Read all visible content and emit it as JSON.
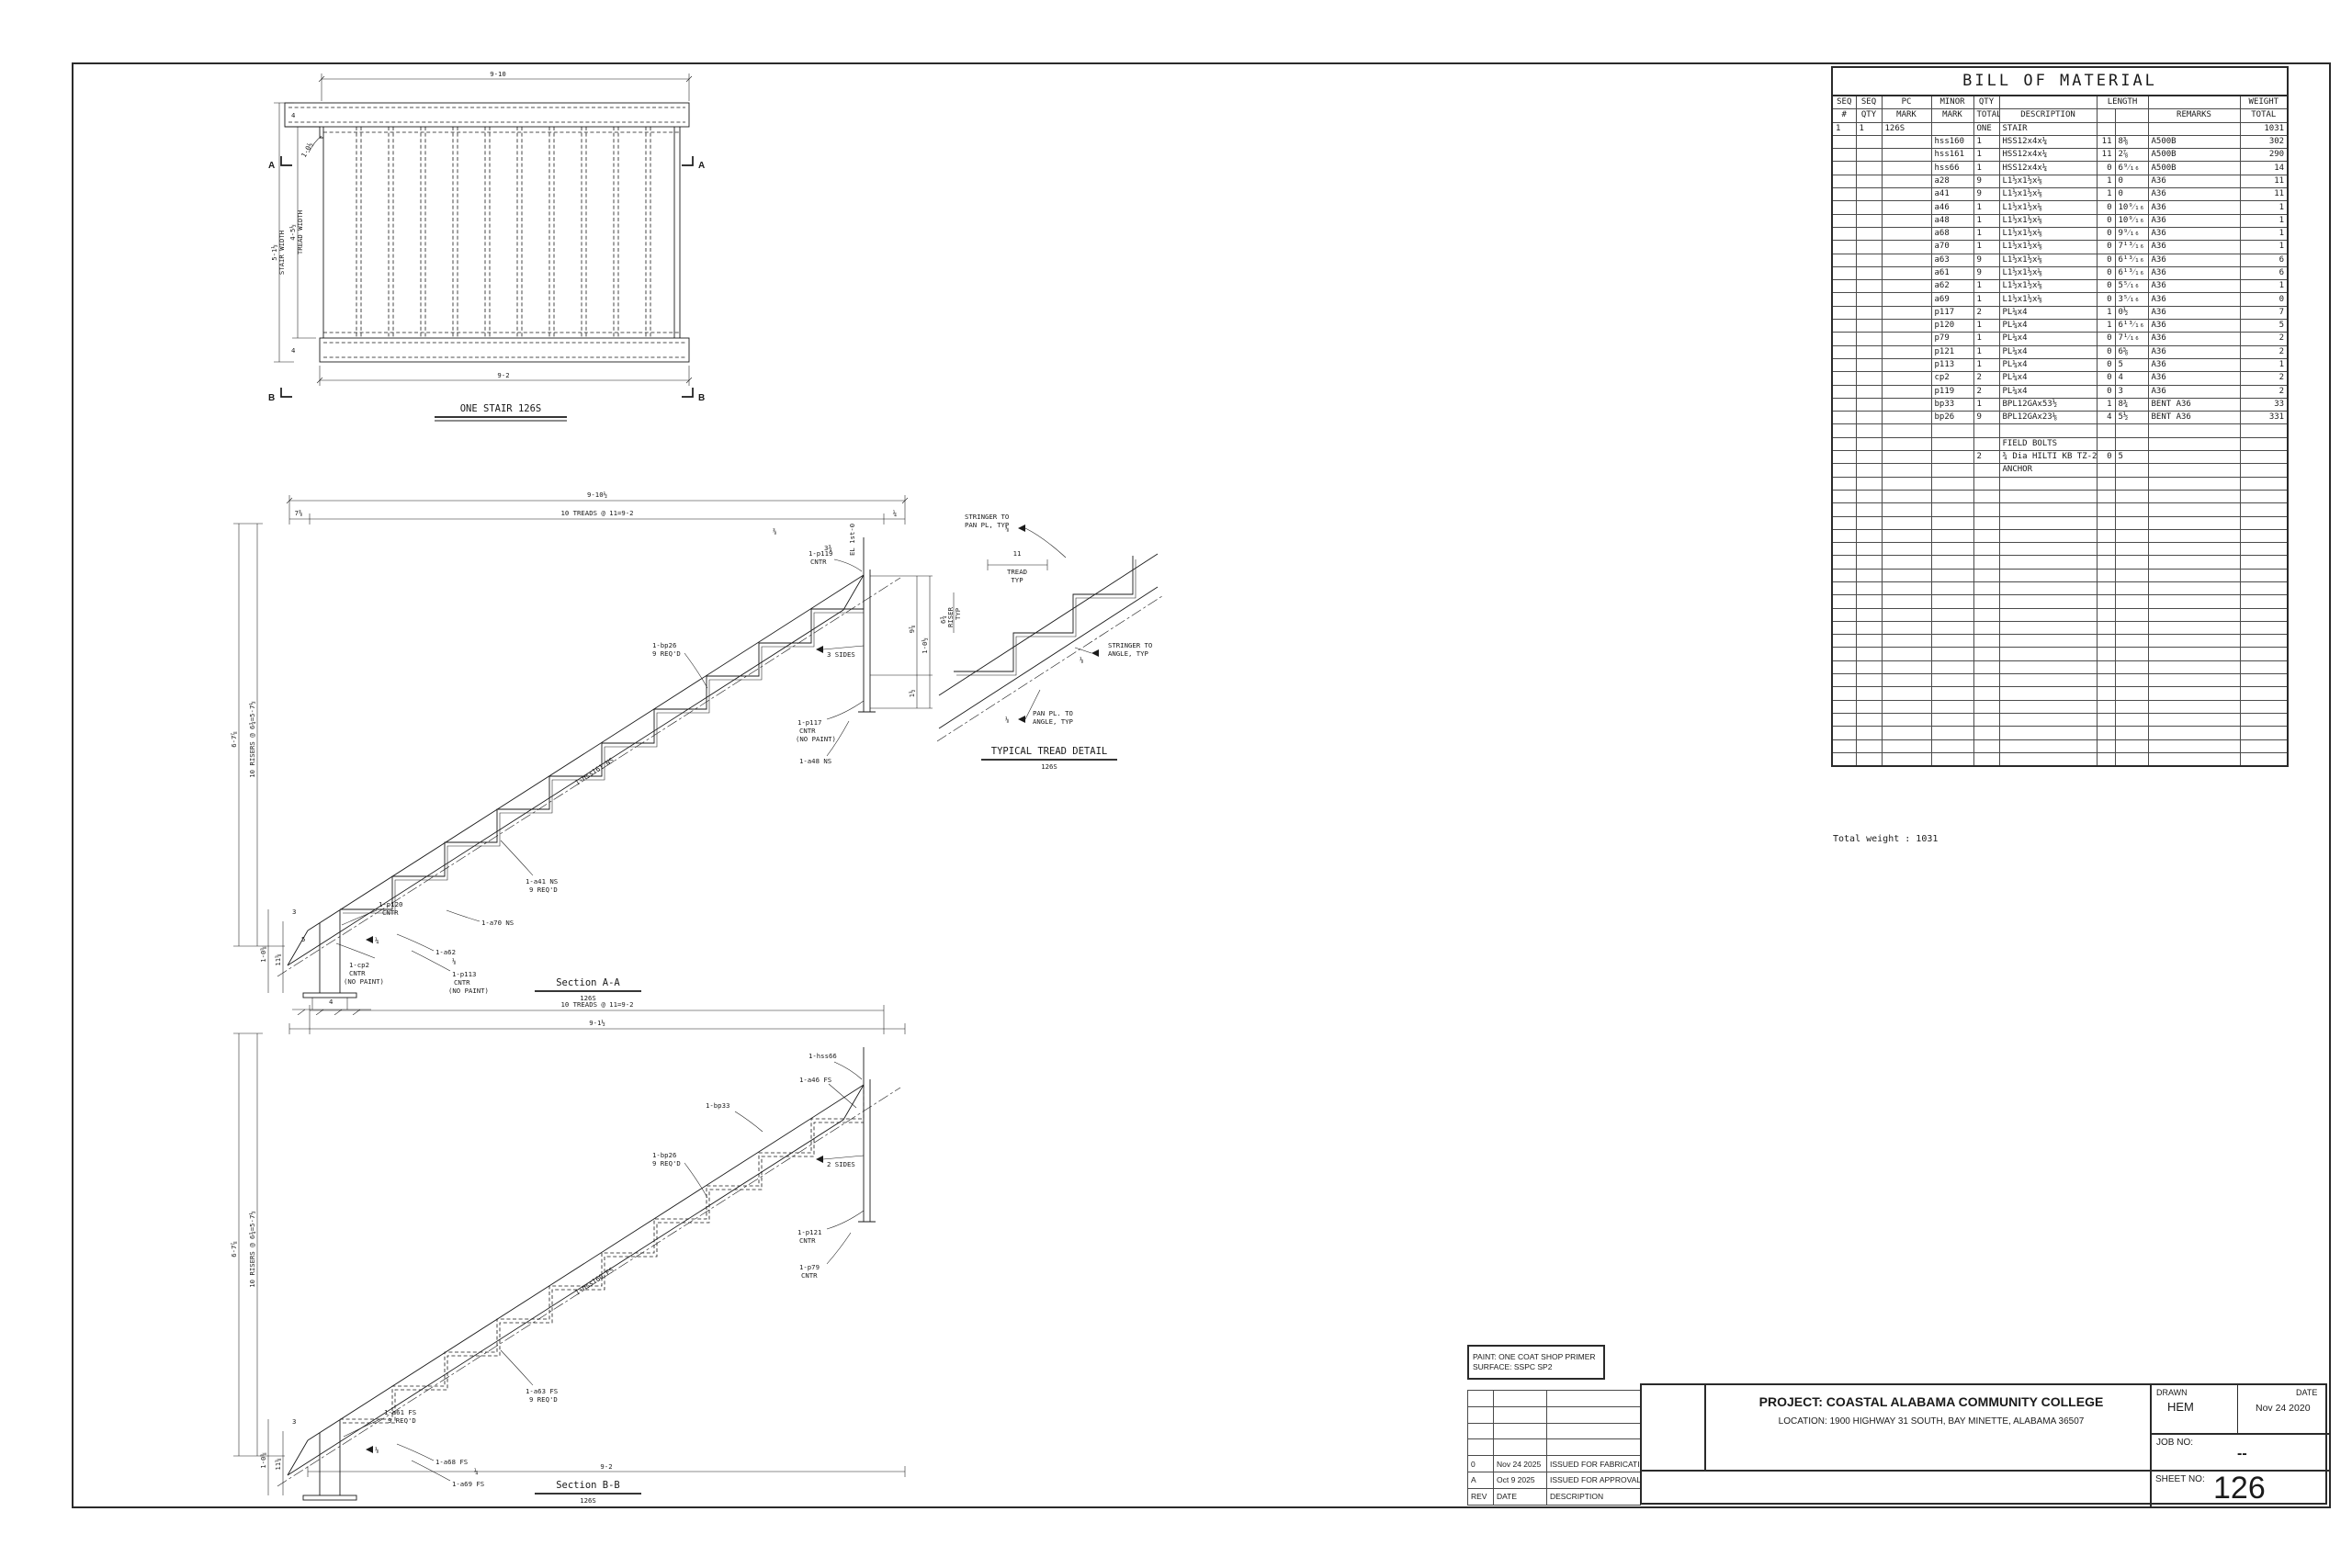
{
  "plan": {
    "title": "ONE STAIR 126S",
    "dim_top": "9-10",
    "dim_bottom": "9-2",
    "sw": "5-1½",
    "sw2": "STAIR WIDTH",
    "tw": "4-5½",
    "tw2": "TREAD WIDTH",
    "d4a": "4",
    "d4b": "4",
    "leader": "1-0½",
    "mA": "A",
    "mB": "B"
  },
  "section_a": {
    "title": "Section A-A",
    "ref": "126S",
    "dim_overall": "9-10½",
    "dim_l": "7⅜",
    "dim_treads": "10 TREADS @ 11=9-2",
    "dim_r": "¼",
    "dim_h_outer": "6-7⅞",
    "dim_risers": "10 RISERS @ 6¾=5-7½",
    "d_38": "⅜",
    "d_334": "3¾",
    "d_978": "9⅞",
    "d_112": "1½",
    "d_1012": "1-0½",
    "d_1058": "1-0⅝",
    "d_1158": "11⅝",
    "d_3": "3",
    "d_5": "5",
    "d_4": "4",
    "el": "EL 1st-0",
    "p119": "1-p119",
    "p119b": "CNTR",
    "sides3": "3 SIDES",
    "p117": "1-p117",
    "p117b": "CNTR",
    "p117c": "(NO PAINT)",
    "a48": "1-a48 NS",
    "bp26": "1-bp26",
    "bp26b": "9 REQ'D",
    "hss": "1-hss161 NS",
    "a41": "1-a41 NS",
    "a41b": "9 REQ'D",
    "a70": "1-a70 NS",
    "p120": "1-p120",
    "p120b": "CNTR",
    "cp2": "1-cp2",
    "cp2b": "CNTR",
    "cp2c": "(NO PAINT)",
    "a62": "1-a62",
    "p113": "1-p113",
    "p113b": "CNTR",
    "p113c": "(NO PAINT)",
    "w14": "¼",
    "w18": "⅛"
  },
  "section_b": {
    "title": "Section B-B",
    "ref": "126S",
    "dim_treads": "10 TREADS @ 11=9-2",
    "dim_912": "9-1½",
    "dim_bottom": "9-2",
    "dim_h_outer": "6-7⅞",
    "dim_risers": "10 RISERS @ 6¾=5-7½",
    "d_1058": "1-0⅝",
    "d_1158": "11⅝",
    "d_3": "3",
    "hss": "1-hss160 FS",
    "hss66": "1-hss66",
    "a46": "1-a46 FS",
    "sides2": "2 SIDES",
    "p121": "1-p121",
    "p121b": "CNTR",
    "p79": "1-p79",
    "p79b": "CNTR",
    "bp33": "1-bp33",
    "bp26": "1-bp26",
    "bp26b": "9 REQ'D",
    "a63": "1-a63 FS",
    "a63b": "9 REQ'D",
    "a61": "1-a61 FS",
    "a61b": "9 REQ'D",
    "a68": "1-a68 FS",
    "a69": "1-a69 FS",
    "w14": "¼",
    "w18": "⅛"
  },
  "tread_detail": {
    "title": "TYPICAL TREAD DETAIL",
    "ref": "126S",
    "s1": "STRINGER TO",
    "s1b": "PAN PL, TYP",
    "t11": "11",
    "t11b": "TREAD",
    "t11c": "TYP",
    "r": "6¾",
    "rb": "RISER",
    "rc": "TYP",
    "s2": "STRINGER TO",
    "s2b": "ANGLE, TYP",
    "s3": "PAN PL. TO",
    "s3b": "ANGLE, TYP",
    "w18": "⅛"
  },
  "bom": {
    "title": "BILL OF MATERIAL",
    "h": {
      "seq": "SEQ",
      "num": "#",
      "seq2": "SEQ",
      "qty": "QTY",
      "pc": "PC",
      "mark": "MARK",
      "minor": "MINOR",
      "mark2": "MARK",
      "qty2": "QTY",
      "total": "TOTAL",
      "desc": "DESCRIPTION",
      "length": "LENGTH",
      "remarks": "REMARKS",
      "weight": "WEIGHT",
      "wtotal": "TOTAL"
    },
    "rows": [
      [
        "1",
        "1",
        "126S",
        "",
        "ONE",
        "STAIR",
        "",
        "",
        "",
        "1031"
      ],
      [
        "",
        "",
        "",
        "hss160",
        "1",
        "HSS12x4x¼",
        "11",
        "8⅜",
        "A500B",
        "302"
      ],
      [
        "",
        "",
        "",
        "hss161",
        "1",
        "HSS12x4x¼",
        "11",
        "2⅞",
        "A500B",
        "290"
      ],
      [
        "",
        "",
        "",
        "hss66",
        "1",
        "HSS12x4x¼",
        "0",
        "6⁹⁄₁₆",
        "A500B",
        "14"
      ],
      [
        "",
        "",
        "",
        "a28",
        "9",
        "L1½x1½x⅛",
        "1",
        "0",
        "A36",
        "11"
      ],
      [
        "",
        "",
        "",
        "a41",
        "9",
        "L1½x1½x⅛",
        "1",
        "0",
        "A36",
        "11"
      ],
      [
        "",
        "",
        "",
        "a46",
        "1",
        "L1½x1½x⅛",
        "0",
        "10⁹⁄₁₆",
        "A36",
        "1"
      ],
      [
        "",
        "",
        "",
        "a48",
        "1",
        "L1½x1½x⅛",
        "0",
        "10⁹⁄₁₆",
        "A36",
        "1"
      ],
      [
        "",
        "",
        "",
        "a68",
        "1",
        "L1½x1½x⅛",
        "0",
        "9⁹⁄₁₆",
        "A36",
        "1"
      ],
      [
        "",
        "",
        "",
        "a70",
        "1",
        "L1½x1½x⅛",
        "0",
        "7¹³⁄₁₆",
        "A36",
        "1"
      ],
      [
        "",
        "",
        "",
        "a63",
        "9",
        "L1½x1½x⅛",
        "0",
        "6¹³⁄₁₆",
        "A36",
        "6"
      ],
      [
        "",
        "",
        "",
        "a61",
        "9",
        "L1½x1½x⅛",
        "0",
        "6¹³⁄₁₆",
        "A36",
        "6"
      ],
      [
        "",
        "",
        "",
        "a62",
        "1",
        "L1½x1½x⅛",
        "0",
        "5⁵⁄₁₆",
        "A36",
        "1"
      ],
      [
        "",
        "",
        "",
        "a69",
        "1",
        "L1½x1½x⅛",
        "0",
        "3⁵⁄₁₆",
        "A36",
        "0"
      ],
      [
        "",
        "",
        "",
        "p117",
        "2",
        "PL¼x4",
        "1",
        "0½",
        "A36",
        "7"
      ],
      [
        "",
        "",
        "",
        "p120",
        "1",
        "PL¼x4",
        "1",
        "6¹³⁄₁₆",
        "A36",
        "5"
      ],
      [
        "",
        "",
        "",
        "p79",
        "1",
        "PL¼x4",
        "0",
        "7¹⁄₁₆",
        "A36",
        "2"
      ],
      [
        "",
        "",
        "",
        "p121",
        "1",
        "PL¼x4",
        "0",
        "6⅝",
        "A36",
        "2"
      ],
      [
        "",
        "",
        "",
        "p113",
        "1",
        "PL¼x4",
        "0",
        "5",
        "A36",
        "1"
      ],
      [
        "",
        "",
        "",
        "cp2",
        "2",
        "PL¼x4",
        "0",
        "4",
        "A36",
        "2"
      ],
      [
        "",
        "",
        "",
        "p119",
        "2",
        "PL¼x4",
        "0",
        "3",
        "A36",
        "2"
      ],
      [
        "",
        "",
        "",
        "bp33",
        "1",
        "BPL12GAx53½",
        "1",
        "8¾",
        "BENT A36",
        "33"
      ],
      [
        "",
        "",
        "",
        "bp26",
        "9",
        "BPL12GAx23⅛",
        "4",
        "5½",
        "BENT A36",
        "331"
      ],
      [
        "",
        "",
        "",
        "",
        "",
        "",
        "",
        "",
        "",
        ""
      ],
      [
        "",
        "",
        "",
        "",
        "",
        "FIELD BOLTS",
        "",
        "",
        "",
        ""
      ],
      [
        "",
        "",
        "",
        "",
        "2",
        "¾ Dia HILTI KB TZ-2",
        "0",
        "5",
        "",
        ""
      ],
      [
        "",
        "",
        "",
        "",
        "",
        "ANCHOR",
        "",
        "",
        "",
        ""
      ],
      [
        "",
        "",
        "",
        "",
        "",
        "",
        "",
        "",
        "",
        ""
      ],
      [
        "",
        "",
        "",
        "",
        "",
        "",
        "",
        "",
        "",
        ""
      ],
      [
        "",
        "",
        "",
        "",
        "",
        "",
        "",
        "",
        "",
        ""
      ],
      [
        "",
        "",
        "",
        "",
        "",
        "",
        "",
        "",
        "",
        ""
      ],
      [
        "",
        "",
        "",
        "",
        "",
        "",
        "",
        "",
        "",
        ""
      ],
      [
        "",
        "",
        "",
        "",
        "",
        "",
        "",
        "",
        "",
        ""
      ],
      [
        "",
        "",
        "",
        "",
        "",
        "",
        "",
        "",
        "",
        ""
      ],
      [
        "",
        "",
        "",
        "",
        "",
        "",
        "",
        "",
        "",
        ""
      ],
      [
        "",
        "",
        "",
        "",
        "",
        "",
        "",
        "",
        "",
        ""
      ],
      [
        "",
        "",
        "",
        "",
        "",
        "",
        "",
        "",
        "",
        ""
      ],
      [
        "",
        "",
        "",
        "",
        "",
        "",
        "",
        "",
        "",
        ""
      ],
      [
        "",
        "",
        "",
        "",
        "",
        "",
        "",
        "",
        "",
        ""
      ],
      [
        "",
        "",
        "",
        "",
        "",
        "",
        "",
        "",
        "",
        ""
      ],
      [
        "",
        "",
        "",
        "",
        "",
        "",
        "",
        "",
        "",
        ""
      ],
      [
        "",
        "",
        "",
        "",
        "",
        "",
        "",
        "",
        "",
        ""
      ],
      [
        "",
        "",
        "",
        "",
        "",
        "",
        "",
        "",
        "",
        ""
      ],
      [
        "",
        "",
        "",
        "",
        "",
        "",
        "",
        "",
        "",
        ""
      ],
      [
        "",
        "",
        "",
        "",
        "",
        "",
        "",
        "",
        "",
        ""
      ],
      [
        "",
        "",
        "",
        "",
        "",
        "",
        "",
        "",
        "",
        ""
      ],
      [
        "",
        "",
        "",
        "",
        "",
        "",
        "",
        "",
        "",
        ""
      ],
      [
        "",
        "",
        "",
        "",
        "",
        "",
        "",
        "",
        "",
        ""
      ],
      [
        "",
        "",
        "",
        "",
        "",
        "",
        "",
        "",
        "",
        ""
      ]
    ],
    "total": "Total weight : 1031"
  },
  "rev": {
    "rows": [
      [
        "",
        "",
        ""
      ],
      [
        "",
        "",
        ""
      ],
      [
        "",
        "",
        ""
      ],
      [
        "",
        "",
        ""
      ],
      [
        "0",
        "Nov 24 2025",
        "ISSUED FOR FABRICATION"
      ],
      [
        "A",
        "Oct 9 2025",
        "ISSUED FOR APPROVAL"
      ],
      [
        "REV",
        "DATE",
        "DESCRIPTION"
      ]
    ]
  },
  "paint": {
    "line1": "PAINT: ONE COAT SHOP PRIMER",
    "line2": "SURFACE: SSPC SP2"
  },
  "title_block": {
    "project": "PROJECT: COASTAL ALABAMA COMMUNITY COLLEGE",
    "location": "LOCATION: 1900 HIGHWAY 31 SOUTH, BAY MINETTE, ALABAMA 36507",
    "drawn_label": "DRAWN",
    "drawn": "HEM",
    "date_label": "DATE",
    "date": "Nov 24 2020",
    "job_label": "JOB NO:",
    "job": "--",
    "sheet_label": "SHEET NO:",
    "sheet": "126"
  }
}
